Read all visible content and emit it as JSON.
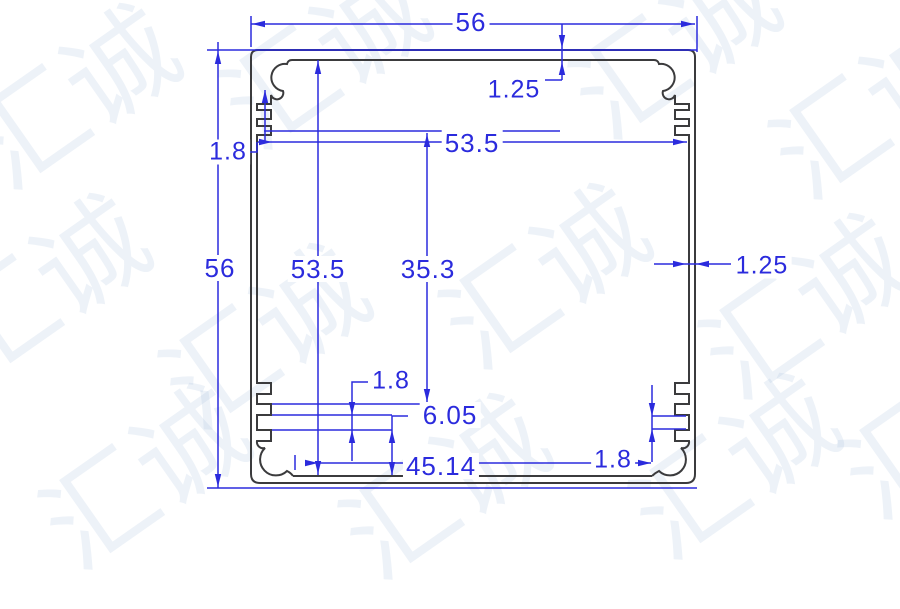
{
  "drawing": {
    "type": "extrusion-profile-cross-section",
    "units": "mm"
  },
  "dims": {
    "top_width": {
      "value": "56",
      "meaning": "overall width"
    },
    "top_wall": {
      "value": "1.25",
      "meaning": "top wall thickness"
    },
    "left_wall": {
      "value": "1.8",
      "meaning": "left wall thickness"
    },
    "inner_width": {
      "value": "53.5",
      "meaning": "inner width"
    },
    "overall_height": {
      "value": "56",
      "meaning": "overall height"
    },
    "inner_height": {
      "value": "53.5",
      "meaning": "inner height"
    },
    "slot_height": {
      "value": "35.3",
      "meaning": "slot region height"
    },
    "right_wall": {
      "value": "1.25",
      "meaning": "right wall thickness"
    },
    "rib_slot_left": {
      "value": "1.8",
      "meaning": "left rib slot width"
    },
    "rib_offset": {
      "value": "6.05",
      "meaning": "rib offset from bottom"
    },
    "boss_spacing": {
      "value": "45.14",
      "meaning": "screw boss spacing"
    },
    "rib_slot_right": {
      "value": "1.8",
      "meaning": "right rib slot width"
    }
  },
  "watermark": {
    "text": "汇诚"
  },
  "colors": {
    "dimension": "#2b2bdd",
    "outline": "#3b3b3d",
    "watermark": "#8cafd2",
    "background": "#ffffff"
  }
}
